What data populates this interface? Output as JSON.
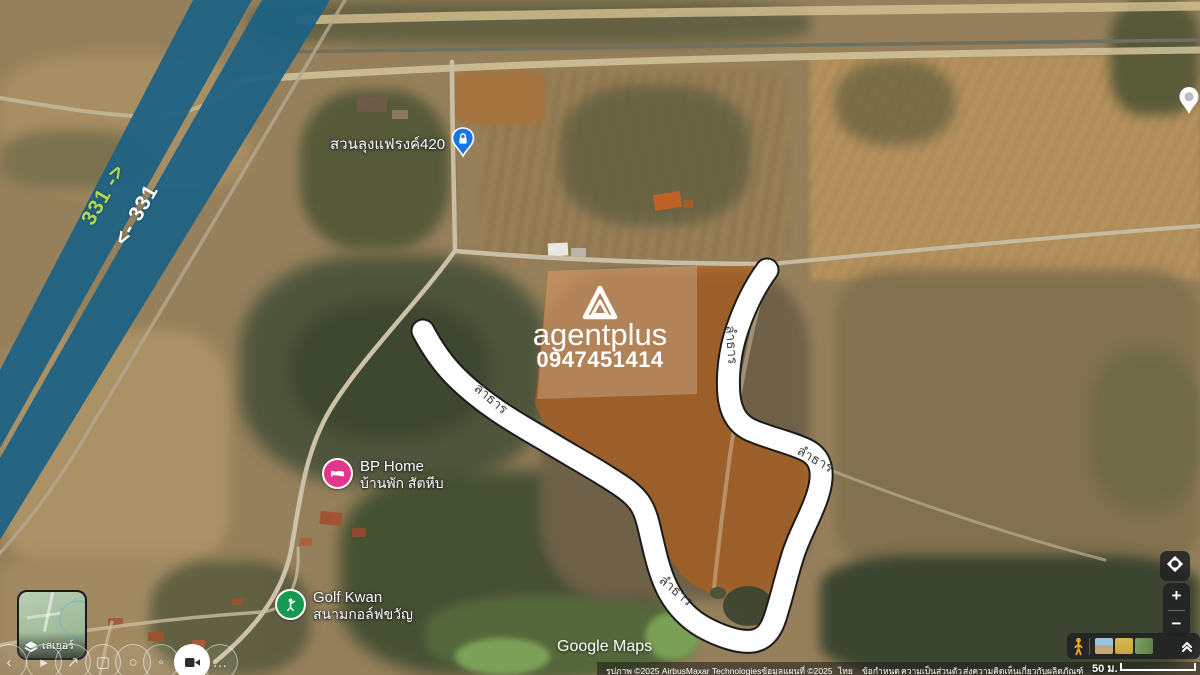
{
  "map": {
    "watermark": {
      "brand": "agentplus",
      "phone": "0947451414"
    },
    "highway": {
      "label_ne": "331 ->",
      "label_sw": "<- 331",
      "road_color": "#1e6284",
      "label_ne_color": "#b5d94c",
      "label_sw_color": "#ffffff"
    },
    "pois": [
      {
        "name": "สวนลุงแฟรงค์420",
        "icon": "lock-pin-icon",
        "color": "#1a73e8"
      },
      {
        "name": "BP Home",
        "subtitle": "บ้านพัก สัตหีบ",
        "icon": "lodging-icon",
        "color": "#e0368c"
      },
      {
        "name": "Golf Kwan",
        "subtitle": "สนามกอล์ฟขวัญ",
        "icon": "golf-icon",
        "color": "#169a52"
      }
    ],
    "stream_labels": [
      {
        "text": "ลำธาร"
      },
      {
        "text": "ลำธาร"
      },
      {
        "text": "ลำธาร"
      },
      {
        "text": "ลำธาร"
      }
    ],
    "plot": {
      "fill_color": "#c05f14",
      "outline_color": "#ffffff"
    }
  },
  "branding": {
    "google_logo": "Google Maps"
  },
  "controls": {
    "layers": {
      "label": "เลเยอร์",
      "icon": "layers-icon"
    },
    "zoom_in": "+",
    "zoom_out": "−",
    "scale": {
      "text": "50 ม."
    },
    "my_location_icon": "my-location-icon",
    "collapse_icon": "double-chevron-up-icon",
    "pegman_icon": "pegman-icon",
    "toolbar": [
      {
        "name": "back",
        "glyph": "‹"
      },
      {
        "name": "play",
        "glyph": "▸"
      },
      {
        "name": "share",
        "glyph": "↗"
      },
      {
        "name": "camera",
        "glyph": "▢"
      },
      {
        "name": "search",
        "glyph": "○"
      },
      {
        "name": "voice",
        "glyph": "◦"
      },
      {
        "name": "video",
        "glyph": ""
      },
      {
        "name": "more",
        "glyph": "…"
      }
    ]
  },
  "attribution": {
    "imagery": "รูปภาพ ©2025 AirbusMaxar Technologiesข้อมูลแผนที่ ©2025",
    "region": "ไทย",
    "terms": "ข้อกำหนด",
    "privacy": "ความเป็นส่วนตัว",
    "feedback": "ส่งความคิดเห็นเกี่ยวกับผลิตภัณฑ์"
  }
}
